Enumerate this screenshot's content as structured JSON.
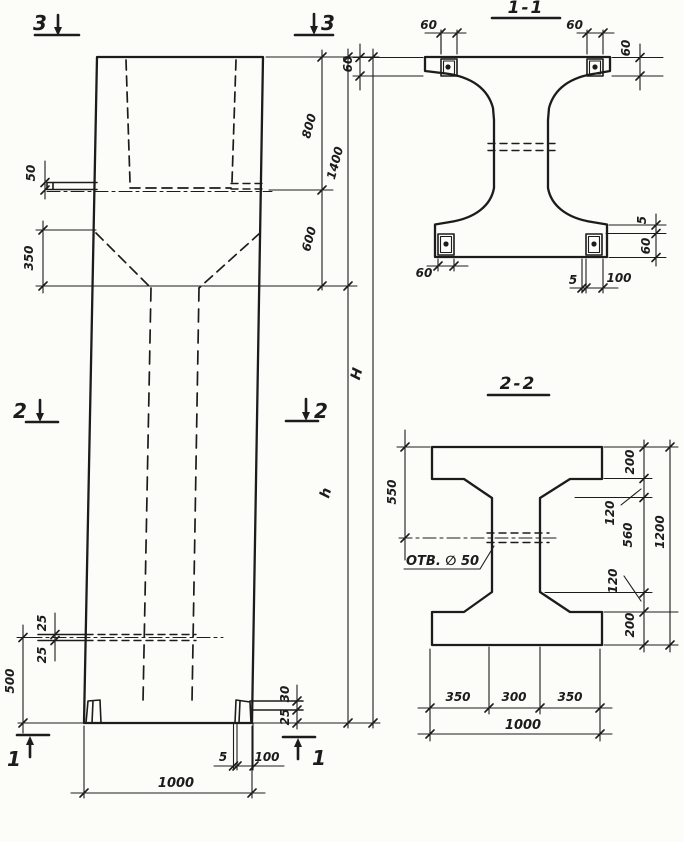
{
  "page": {
    "background": "#fcfcf9",
    "ink": "#1c1c1c"
  },
  "elevation": {
    "section_marks": {
      "top_left": "3",
      "top_right": "3",
      "mid_left": "2",
      "mid_right": "2",
      "bottom_left": "1",
      "bottom_right": "1"
    },
    "dims": {
      "ledge_offset": "50",
      "taper_height": "350",
      "top_upper": "800",
      "top_total": "1400",
      "top_lower": "600",
      "total_height": "H",
      "shaft_height": "h",
      "hole_gap_top": "25",
      "hole_gap_bottom": "25",
      "hole_level": "500",
      "foot_step_a": "30",
      "foot_step_b": "25",
      "base_plate_gap": "5",
      "base_plate_width": "100",
      "base_width": "1000"
    }
  },
  "section_1_1": {
    "title": "1-1",
    "dims": {
      "top_left_width": "60",
      "top_left_height": "60",
      "top_right_width": "60",
      "top_right_height": "60",
      "bottom_left_width": "60",
      "bottom_gap": "5",
      "bottom_plate_width": "100",
      "right_gap": "5",
      "right_plate_height": "60"
    }
  },
  "section_2_2": {
    "title": "2-2",
    "hole_label": "ОТВ. ∅ 50",
    "dims": {
      "top_to_hole": "550",
      "right_top": "200",
      "right_upper": "120",
      "right_middle": "560",
      "right_lower": "120",
      "right_bottom": "200",
      "right_total": "1200",
      "bottom_left": "350",
      "bottom_center": "300",
      "bottom_right": "350",
      "bottom_total": "1000"
    }
  }
}
